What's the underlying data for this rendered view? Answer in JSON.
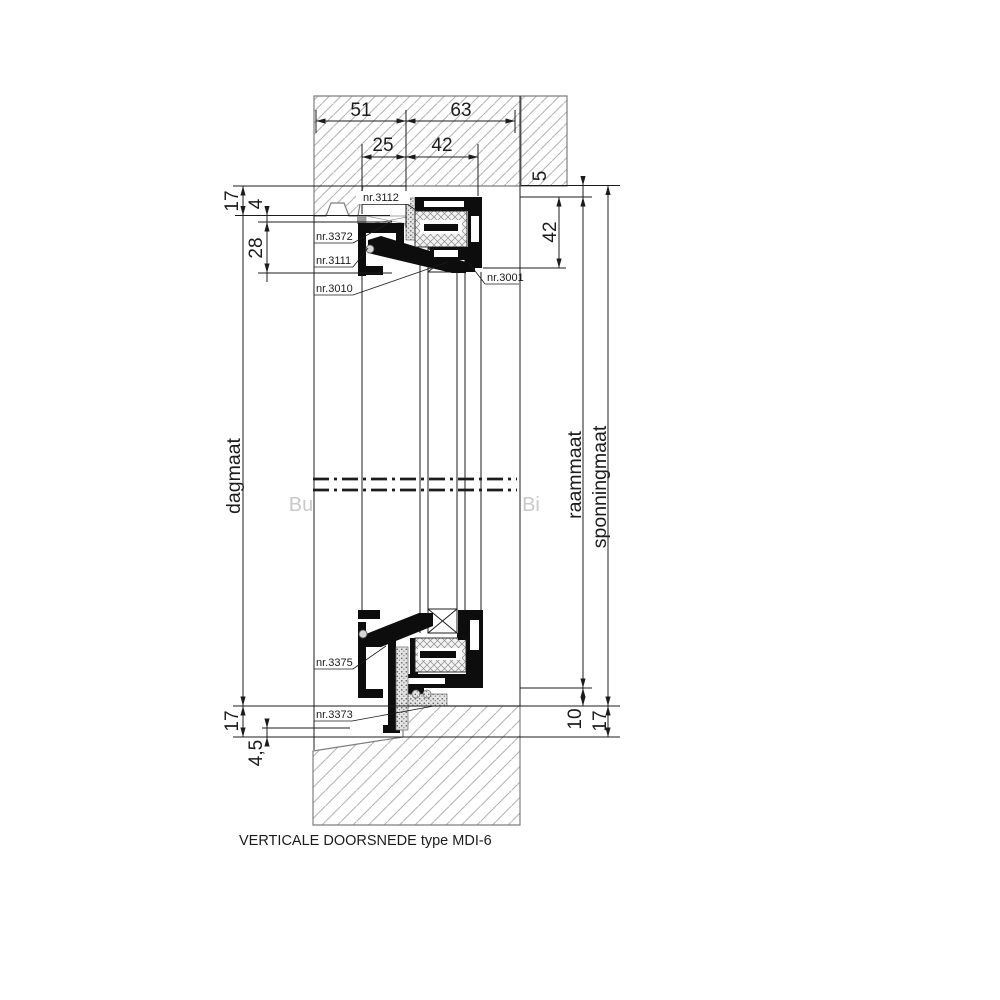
{
  "title": "VERTICALE DOORSNEDE type  MDI-6",
  "watermarks": {
    "outside": "Bu",
    "inside": "Bi"
  },
  "axis_labels": {
    "dagmaat": "dagmaat",
    "raammaat": "raammaat",
    "sponningmaat": "sponningmaat"
  },
  "dims": {
    "w51": "51",
    "w63": "63",
    "w25": "25",
    "w42": "42",
    "h17_top": "17",
    "h4": "4",
    "h28": "28",
    "h5": "5",
    "h42": "42",
    "h17_bottom_left": "17",
    "h45": "4,5",
    "h10": "10",
    "h17_bottom_right": "17"
  },
  "parts": {
    "p3112": "nr.3112",
    "p3372": "nr.3372",
    "p3111": "nr.3111",
    "p3010": "nr.3010",
    "p3001": "nr.3001",
    "p3375": "nr.3375",
    "p3373": "nr.3373"
  },
  "colors": {
    "background": "#ffffff",
    "line": "#1c1c1c",
    "wall_outline": "#7e7e7e",
    "wall_hatch": "#b5b5b5",
    "watermark": "#c9c9c9",
    "profile": "#0d0d0d",
    "insulation_hatch": "#8c8c8c",
    "seal_fill": "#e4e4e4",
    "seal_dot": "#606060",
    "kit_gray": "#9b9b9b"
  }
}
